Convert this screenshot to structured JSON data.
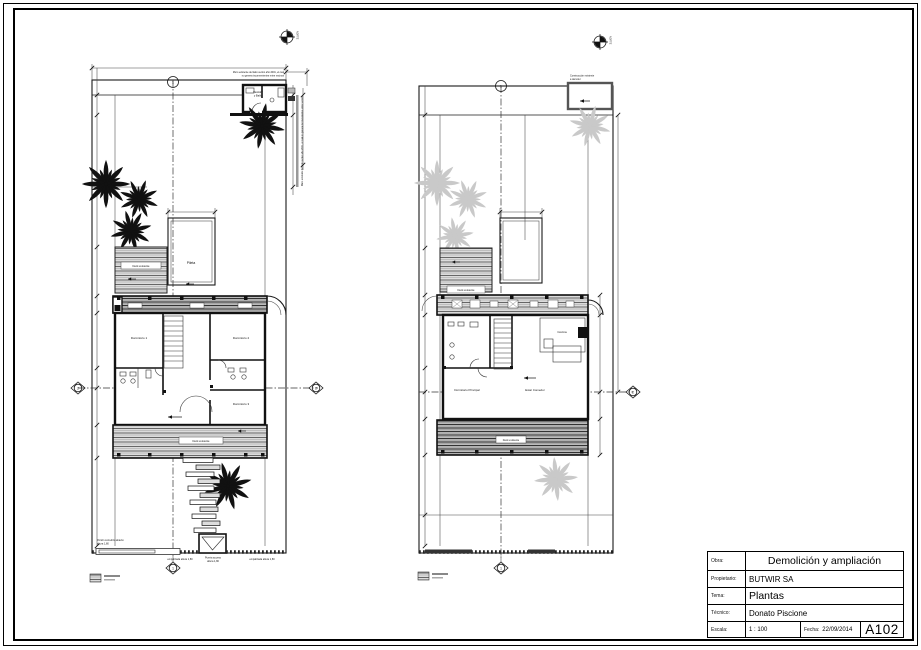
{
  "title_block": {
    "rows": [
      {
        "label": "Obra:",
        "value": "Demolición y ampliación"
      },
      {
        "label": "Propietario:",
        "value": "BUTWIR SA"
      },
      {
        "label": "Tema:",
        "value": "Plantas"
      },
      {
        "label": "Técnico:",
        "value": "Donato Piscione"
      }
    ],
    "scale_label": "Escala:",
    "scale_value": "1 : 100",
    "date_label": "Fecha:",
    "date_value": "22/09/2014",
    "sheet_number": "A102"
  },
  "plan_left": {
    "north_label": "NORTE",
    "note_top_line1": "Muro existente del lado vecino año 2001, el cual",
    "note_top_line2": "no genera inconvenientes entre vecinos",
    "note_side": "Muro existente del lado vecino año 2001, el cual no genera inconvenientes entre vecinos",
    "room_vestidor_line1": "Vestidor",
    "room_vestidor_line2": "y Baño",
    "pool_label": "Pileta",
    "deck_upper_label": "Deck existente",
    "deck_lower_label": "Deck existente",
    "room_dorm1": "Dormitorio 1",
    "room_dorm2": "Dormitorio 2",
    "room_dorm3": "Dormitorio 3",
    "gate_note_line1": "Portón corredizo abierto",
    "gate_note_line2": "altura 1,80",
    "fence_left_label": "empalizada altura 1,80",
    "entry_label_line1": "Puerta acceso",
    "entry_label_line2": "altura 1,80",
    "fence_right_label": "empalizada altura 1,80",
    "grid_bubble_top": "1",
    "grid_bubble_bottom": "1",
    "grid_bubble_left": "2",
    "grid_bubble_right": "2"
  },
  "plan_right": {
    "north_label": "NORTE",
    "demo_note_line1": "Construcción existente",
    "demo_note_line2": "a demoler",
    "room_cocina": "Cocina",
    "room_dorm_principal": "Dormitorio Principal",
    "room_estar": "Estar Comedor",
    "deck_upper_label": "Deck existente",
    "deck_lower_label": "Deck existente",
    "grid_bubble_top": "1",
    "grid_bubble_bottom": "1",
    "grid_bubble_right": "2"
  },
  "colors": {
    "line": "#1a1a1a",
    "palm_dark": "#111111",
    "palm_light": "#c9c9c9",
    "deck_fill": "#d9d9d9"
  }
}
